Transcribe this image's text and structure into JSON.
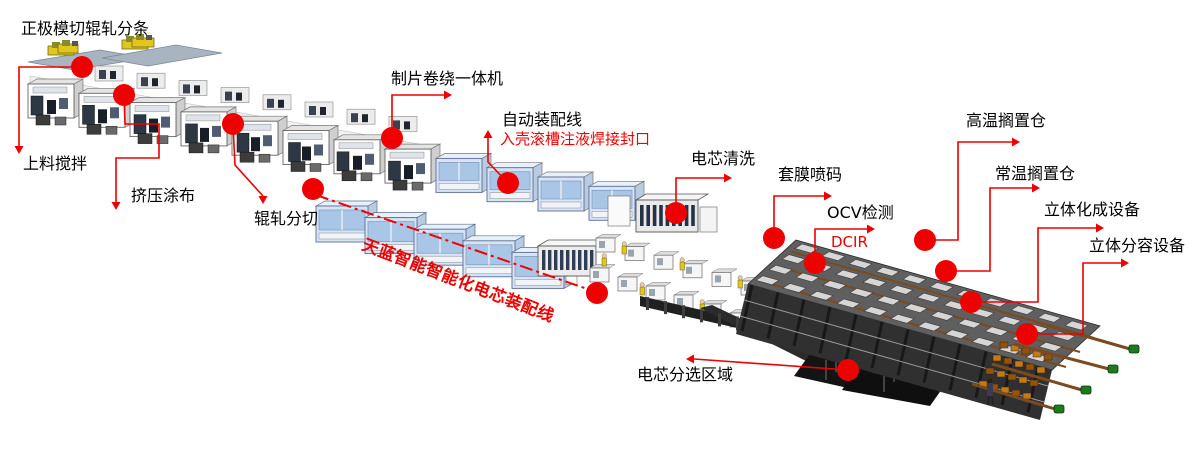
{
  "diagram_title": "正极模切辊轧分条",
  "palette": {
    "annotation_red": "#ee0000",
    "label_black": "#000000",
    "machine_white": "#ffffff",
    "machine_gray": "#ececec",
    "machine_blue": "#d7e4f4",
    "glass_blue": "#aac6e6",
    "rack_dark": "#303030",
    "rack_top": "#5f5f5f",
    "tray_gray": "#d6d6d6",
    "rail_brown": "#7a4a20",
    "cap_green": "#1f7a1f",
    "worker_yellow": "#e2c61c",
    "platform_black": "#141414"
  },
  "banner": {
    "text": "天蓝智能智能化电芯装配线",
    "color": "#ee0000",
    "rotate_deg": 21,
    "text_x": 361,
    "text_y": 249,
    "font_size": 16.5,
    "line": {
      "x1": 316,
      "y1": 195,
      "x2": 596,
      "y2": 292
    },
    "end_dots": [
      [
        313,
        189
      ],
      [
        597,
        293
      ]
    ]
  },
  "annotations": [
    {
      "id": "positive-die-cut-slitting",
      "label": "正极模切辊轧分条",
      "label_x": 21,
      "label_y": 21,
      "dot": null,
      "path": null,
      "arrow": null
    },
    {
      "id": "feeding-mixing",
      "label": "上料搅拌",
      "label_x": 23,
      "label_y": 156,
      "dot": {
        "x": 82,
        "y": 67
      },
      "path": [
        [
          82,
          67
        ],
        [
          19,
          67
        ],
        [
          19,
          146
        ]
      ],
      "arrow": "down"
    },
    {
      "id": "extrusion-coating",
      "label": "挤压涂布",
      "label_x": 131,
      "label_y": 188,
      "dot": {
        "x": 124,
        "y": 95
      },
      "path": [
        [
          124,
          95
        ],
        [
          125,
          124
        ],
        [
          159,
          124
        ],
        [
          159,
          158
        ],
        [
          116,
          158
        ],
        [
          116,
          202
        ]
      ],
      "arrow": "down"
    },
    {
      "id": "roll-slitting",
      "label": "辊轧分切",
      "label_x": 254,
      "label_y": 211,
      "dot": {
        "x": 233,
        "y": 124
      },
      "path": [
        [
          233,
          124
        ],
        [
          235,
          165
        ],
        [
          263,
          196
        ]
      ],
      "arrow": "down"
    },
    {
      "id": "sheet-winding-machine",
      "label": "制片卷绕一体机",
      "label_x": 391,
      "label_y": 71,
      "dot": {
        "x": 392,
        "y": 138
      },
      "path": [
        [
          392,
          138
        ],
        [
          392,
          95
        ],
        [
          444,
          95
        ]
      ],
      "arrow": "right"
    },
    {
      "id": "auto-assembly-line",
      "label": "自动装配线",
      "label_x": 502,
      "label_y": 112,
      "sub_label": "入壳滚槽注液焊接封口",
      "sub_x": 500,
      "sub_y": 132,
      "dot": {
        "x": 508,
        "y": 183
      },
      "path": [
        [
          508,
          183
        ],
        [
          488,
          162
        ],
        [
          488,
          138
        ]
      ],
      "arrow": "up"
    },
    {
      "id": "cell-cleaning",
      "label": "电芯清洗",
      "label_x": 691,
      "label_y": 151,
      "dot": {
        "x": 676,
        "y": 213
      },
      "path": [
        [
          676,
          213
        ],
        [
          676,
          178
        ],
        [
          724,
          178
        ]
      ],
      "arrow": "right"
    },
    {
      "id": "film-wrap-coding",
      "label": "套膜喷码",
      "label_x": 778,
      "label_y": 167,
      "dot": {
        "x": 774,
        "y": 238
      },
      "path": [
        [
          774,
          238
        ],
        [
          774,
          196
        ],
        [
          824,
          196
        ]
      ],
      "arrow": "right"
    },
    {
      "id": "ocv-test",
      "label": "OCV检测",
      "label_x": 827,
      "label_y": 205,
      "sub_label": "DCIR",
      "sub_x": 831,
      "sub_y": 235,
      "dot": {
        "x": 815,
        "y": 263
      },
      "path": [
        [
          815,
          263
        ],
        [
          815,
          229
        ],
        [
          867,
          229
        ]
      ],
      "arrow": "right"
    },
    {
      "id": "high-temp-aging",
      "label": "高温搁置仓",
      "label_x": 966,
      "label_y": 113,
      "dot": {
        "x": 925,
        "y": 240
      },
      "path": [
        [
          925,
          240
        ],
        [
          958,
          240
        ],
        [
          958,
          142
        ],
        [
          1012,
          142
        ]
      ],
      "arrow": "right"
    },
    {
      "id": "normal-temp-aging",
      "label": "常温搁置仓",
      "label_x": 995,
      "label_y": 166,
      "dot": {
        "x": 946,
        "y": 271
      },
      "path": [
        [
          946,
          271
        ],
        [
          990,
          271
        ],
        [
          990,
          188
        ],
        [
          1032,
          188
        ]
      ],
      "arrow": "right"
    },
    {
      "id": "stereo-formation-equipment",
      "label": "立体化成设备",
      "label_x": 1044,
      "label_y": 202,
      "dot": {
        "x": 971,
        "y": 302
      },
      "path": [
        [
          971,
          302
        ],
        [
          1038,
          302
        ],
        [
          1038,
          228
        ],
        [
          1096,
          228
        ]
      ],
      "arrow": "right"
    },
    {
      "id": "stereo-grading-equipment",
      "label": "立体分容设备",
      "label_x": 1089,
      "label_y": 238,
      "dot": {
        "x": 1027,
        "y": 334
      },
      "path": [
        [
          1027,
          334
        ],
        [
          1083,
          334
        ],
        [
          1083,
          263
        ],
        [
          1121,
          263
        ]
      ],
      "arrow": "right"
    },
    {
      "id": "cell-sorting-area",
      "label": "电芯分选区域",
      "label_x": 637,
      "label_y": 367,
      "dot": {
        "x": 848,
        "y": 370
      },
      "path": [
        [
          848,
          370
        ],
        [
          694,
          359
        ]
      ],
      "arrow": "left"
    }
  ]
}
